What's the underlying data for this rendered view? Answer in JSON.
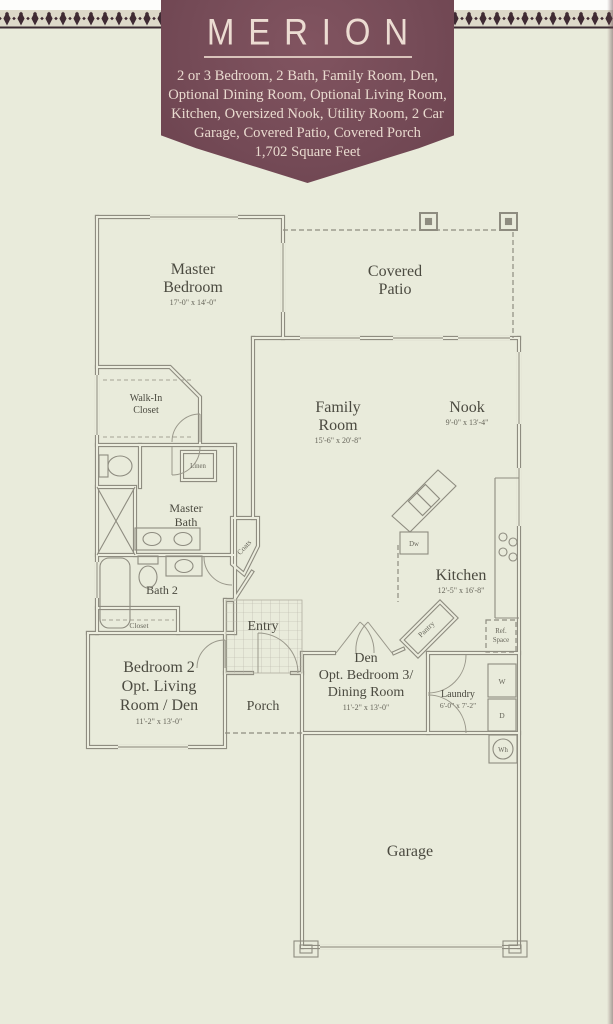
{
  "banner": {
    "title": "MERION",
    "description": "2 or 3 Bedroom, 2 Bath, Family Room, Den, Optional Dining Room, Optional Living Room, Kitchen, Oversized Nook, Utility Room, 2 Car Garage, Covered Patio, Covered Porch",
    "square_feet": "1,702 Square Feet",
    "colors": {
      "background": "#754b57",
      "text": "#eadbd1"
    }
  },
  "floor_plan": {
    "colors": {
      "walls": "#8e8c80",
      "labels": "#4b4a40",
      "paper": "#e9ebdb"
    },
    "rooms": {
      "master_bedroom": {
        "name_line1": "Master",
        "name_line2": "Bedroom",
        "dims": "17'-0\" x 14'-0\""
      },
      "covered_patio": {
        "name_line1": "Covered",
        "name_line2": "Patio"
      },
      "family_room": {
        "name_line1": "Family",
        "name_line2": "Room",
        "dims": "15'-6\" x 20'-8\""
      },
      "nook": {
        "name_line1": "Nook",
        "dims": "9'-0\" x 13'-4\""
      },
      "walk_in_closet": {
        "name_line1": "Walk-In",
        "name_line2": "Closet"
      },
      "linen": {
        "name_line1": "Linen"
      },
      "master_bath": {
        "name_line1": "Master",
        "name_line2": "Bath"
      },
      "bath_2": {
        "name_line1": "Bath 2"
      },
      "closet": {
        "name_line1": "Closet"
      },
      "coats": {
        "name_line1": "Coats"
      },
      "entry": {
        "name_line1": "Entry"
      },
      "porch": {
        "name_line1": "Porch"
      },
      "bedroom_2": {
        "name_line1": "Bedroom 2",
        "name_line2": "Opt. Living",
        "name_line3": "Room / Den",
        "dims": "11'-2\" x 13'-0\""
      },
      "den": {
        "name_line1": "Den",
        "name_line2": "Opt. Bedroom 3/",
        "name_line3": "Dining Room",
        "dims": "11'-2\" x 13'-0\""
      },
      "kitchen": {
        "name_line1": "Kitchen",
        "dims": "12'-5\" x 16'-8\""
      },
      "laundry": {
        "name_line1": "Laundry",
        "dims": "6'-0\" x 7'-2\""
      },
      "garage": {
        "name_line1": "Garage"
      },
      "pantry": {
        "name_line1": "Pantry"
      },
      "ref_space": {
        "name_line1": "Ref.",
        "name_line2": "Space"
      }
    },
    "appliances": {
      "dishwasher": "Dw",
      "washer": "W",
      "dryer": "D",
      "water_heater": "Wh"
    }
  }
}
